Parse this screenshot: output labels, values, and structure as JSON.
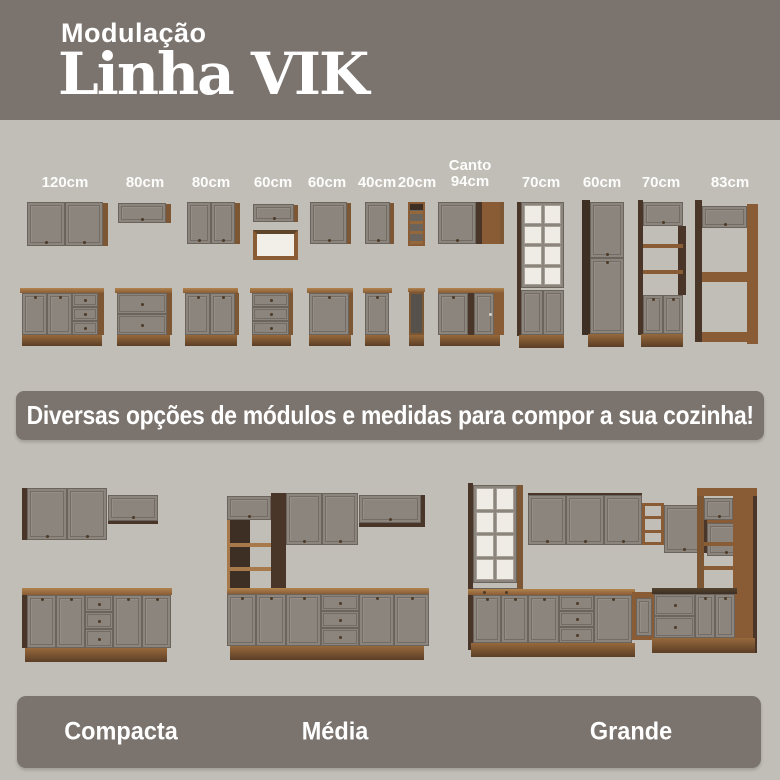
{
  "header": {
    "kicker": "Modulação",
    "title": "Linha VIK"
  },
  "modules": {
    "labels": [
      "120cm",
      "80cm",
      "80cm",
      "60cm",
      "60cm",
      "40cm",
      "20cm",
      "70cm",
      "60cm",
      "70cm",
      "83cm"
    ],
    "corner_label": {
      "line1": "Canto",
      "line2": "94cm"
    }
  },
  "banner": {
    "text": "Diversas opções de módulos e medidas para compor a sua cozinha!"
  },
  "kitchens": {
    "items": [
      {
        "name": "Compacta"
      },
      {
        "name": "Média"
      },
      {
        "name": "Grande"
      }
    ]
  },
  "colors": {
    "band_bg": "#7b746e",
    "page_bg": "#c1bdb7",
    "door_gray": "#8b857d",
    "wood": "#8a5c36",
    "wood_dark": "#4a3628",
    "white_interior": "#f2efe9",
    "text": "#ffffff"
  }
}
